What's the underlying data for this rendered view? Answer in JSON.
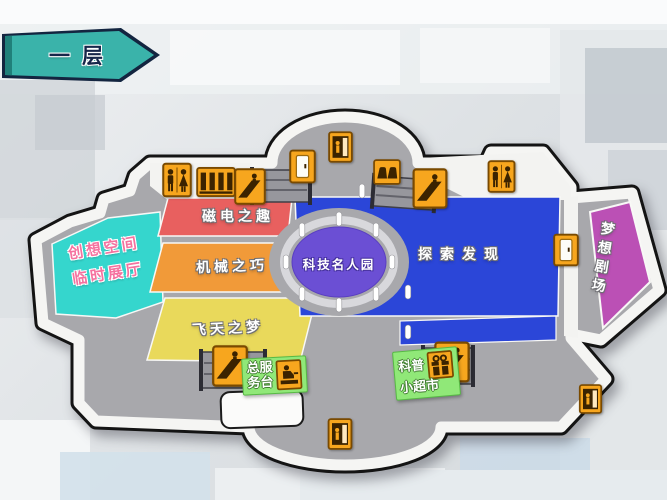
{
  "banner": {
    "label": "一层"
  },
  "zones": {
    "creative": {
      "line1": "创想空间",
      "line2": "临时展厅",
      "color": "#35d6cd"
    },
    "magnet": {
      "label": "磁电之趣",
      "color": "#e8605f"
    },
    "machine": {
      "label": "机械之巧",
      "color": "#f19a39"
    },
    "flight": {
      "label": "飞天之梦",
      "color": "#e9d95b"
    },
    "explore": {
      "label": "探索发现",
      "color": "#2b46d8"
    },
    "celebrity": {
      "label": "科技名人园",
      "color": "#6b4fd4"
    },
    "theater": {
      "label": "梦想剧场",
      "color": "#bb50b5"
    }
  },
  "badges": {
    "service": {
      "line1": "总服",
      "line2": "务台",
      "color": "#90e878"
    },
    "market": {
      "line1": "科普",
      "line2": "小超市",
      "color": "#90e878"
    }
  },
  "icons": {
    "restroom": "restroom-icon",
    "elevator": "elevator-icon",
    "escalator": "escalator-icon",
    "exit_door": "exit-door-icon",
    "lockers": "lockers-icon",
    "door": "door-icon",
    "service_desk": "service-desk-icon",
    "gift_shop": "gift-shop-icon"
  },
  "colors": {
    "banner_teal": "#3ab3aa",
    "floor_gray": "#a8a8ac",
    "wall_white": "#f5f5f3",
    "outline_black": "#141414",
    "icon_orange": "#f7a61e",
    "badge_green": "#90e878"
  }
}
